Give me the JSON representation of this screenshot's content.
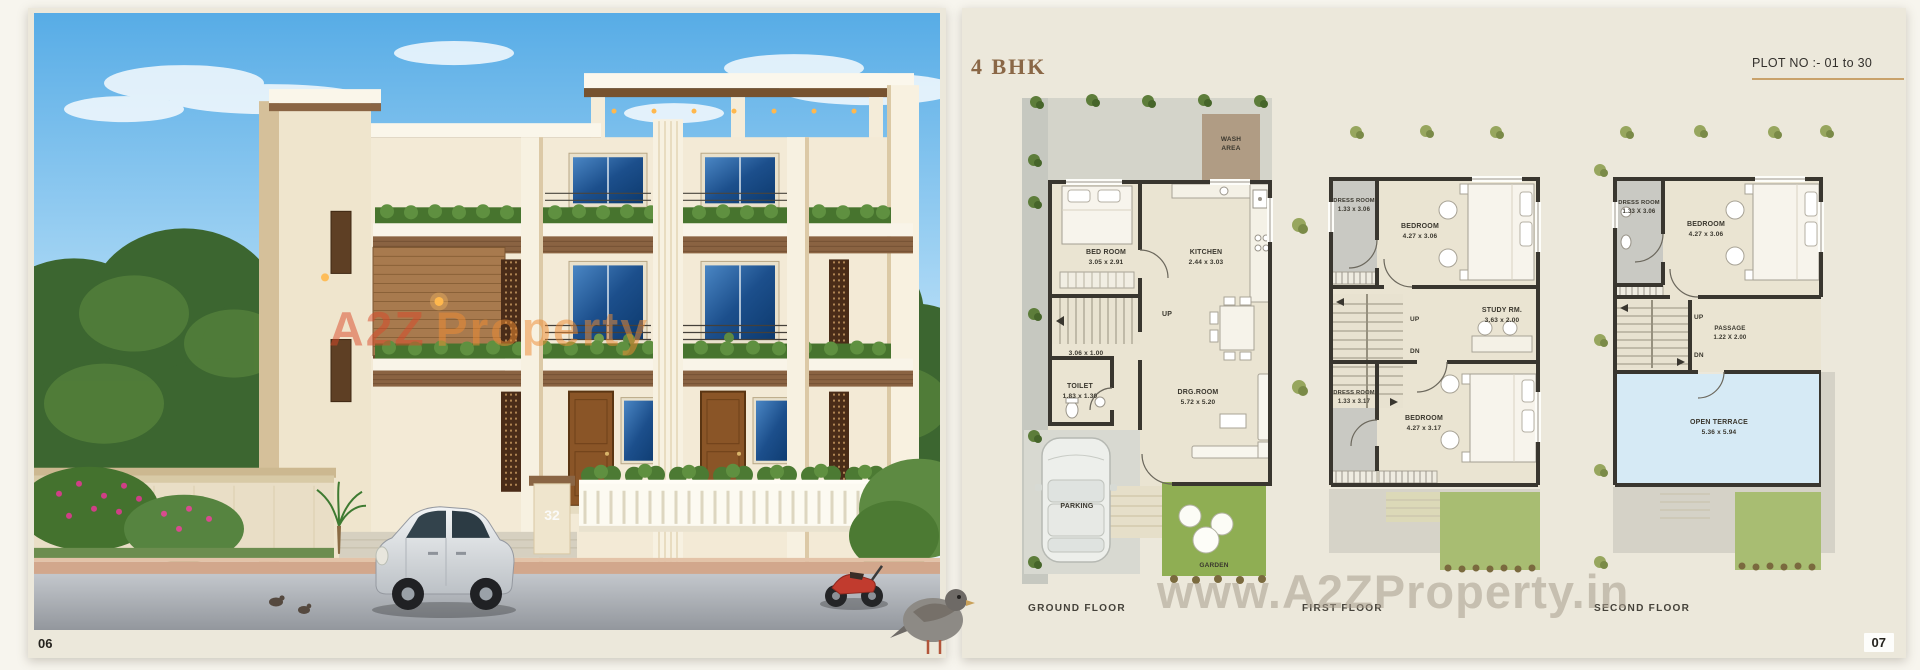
{
  "spread": {
    "left_page_number": "06",
    "right_page_number": "07"
  },
  "left_page": {
    "watermark": {
      "part1": "A2Z",
      "part2": "Property"
    },
    "house_number": "32"
  },
  "right_page": {
    "title": "4 BHK",
    "plot_no": "PLOT NO :- 01 to 30",
    "watermark": "www.A2ZProperty.in",
    "floors": {
      "ground": {
        "label": "GROUND FLOOR",
        "wash_line1": "WASH",
        "wash_line2": "AREA",
        "bed_room_name": "BED ROOM",
        "bed_room_dims": "3.05 x 2.91",
        "kitchen_name": "KITCHEN",
        "kitchen_dims": "2.44 x 3.03",
        "up": "UP",
        "stair_dims": "3.06 x 1.00",
        "toilet_name": "TOILET",
        "toilet_dims": "1.83 x 1.30",
        "drg_name": "DRG.ROOM",
        "drg_dims": "5.72 x 5.20",
        "parking": "PARKING",
        "garden": "GARDEN"
      },
      "first": {
        "label": "FIRST FLOOR",
        "dress1_name": "DRESS ROOM",
        "dress1_dims": "1.33 x 3.06",
        "bedroom1_name": "BEDROOM",
        "bedroom1_dims": "4.27 x 3.06",
        "up": "UP",
        "dn": "DN",
        "study_name": "STUDY RM.",
        "study_dims": "3.63 x 2.00",
        "dress2_name": "DRESS ROOM",
        "dress2_dims": "1.33 x 3.17",
        "bedroom2_name": "BEDROOM",
        "bedroom2_dims": "4.27 x 3.17"
      },
      "second": {
        "label": "SECOND FLOOR",
        "dress_name": "DRESS ROOM",
        "dress_dims": "1.33 X 3.06",
        "bedroom_name": "BEDROOM",
        "bedroom_dims": "4.27 x 3.06",
        "up": "UP",
        "dn": "DN",
        "passage_name": "PASSAGE",
        "passage_dims": "1.22 X 2.00",
        "terrace_name": "OPEN TERRACE",
        "terrace_dims": "5.36 x 5.94"
      }
    },
    "colors": {
      "accent_brown": "#8a6746",
      "gold_rule": "#c9a26b",
      "plan_wall": "#39362f",
      "room_floor": "#eae4d2",
      "dress_floor": "#c9c9c3",
      "garden_green": "#8fae53",
      "terrace_blue": "#d6eaf5",
      "wash_tan": "#b09c84",
      "page_cream": "#ece8db"
    }
  }
}
